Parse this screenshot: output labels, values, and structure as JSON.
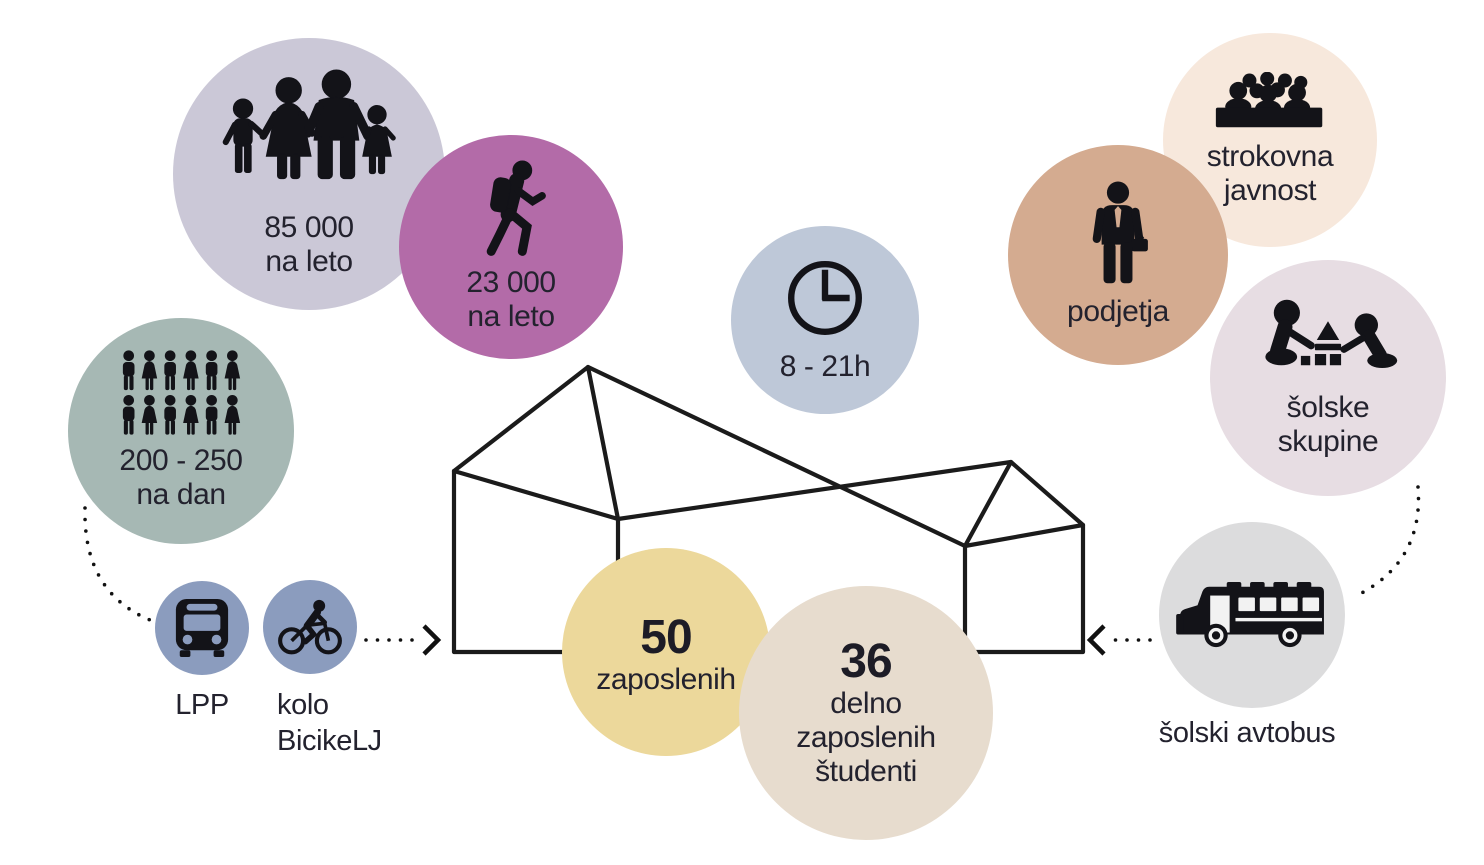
{
  "bubbles": {
    "annual_visitors": {
      "value": "85 000",
      "unit": "na leto"
    },
    "annual_hikers": {
      "value": "23 000",
      "unit": "na leto"
    },
    "daily_visitors": {
      "value": "200 - 250",
      "unit": "na dan"
    },
    "opening_hours": {
      "value": "8 - 21h"
    },
    "companies": {
      "label": "podjetja"
    },
    "professional_public": {
      "line1": "strokovna",
      "line2": "javnost"
    },
    "school_groups": {
      "line1": "šolske",
      "line2": "skupine"
    },
    "employees": {
      "value": "50",
      "label": "zaposlenih"
    },
    "student_workers": {
      "value": "36",
      "line1": "delno",
      "line2": "zaposlenih",
      "line3": "študenti"
    }
  },
  "labels": {
    "city_bus": "LPP",
    "bike_line1": "kolo",
    "bike_line2": "BicikeLJ",
    "school_bus": "šolski avtobus"
  },
  "icons": [
    "family-icon",
    "hiker-icon",
    "people-grid-icon",
    "city-bus-icon",
    "bicycle-icon",
    "clock-icon",
    "businessman-icon",
    "audience-icon",
    "children-blocks-icon",
    "school-bus-icon"
  ],
  "palette": {
    "annual_visitors_circle": "#cbc8d7",
    "annual_hikers_circle": "#b36ba8",
    "daily_visitors_circle": "#a6b8b4",
    "transport_circle": "#8b9cbe",
    "opening_hours_circle": "#bec8d8",
    "companies_circle": "#d4ab90",
    "professional_public_circle": "#f7e8dc",
    "school_groups_circle": "#e7dde3",
    "school_bus_circle": "#dcdcdd",
    "employees_circle": "#ecd89b",
    "student_workers_circle": "#e7dcce",
    "ink": "#1b1b1b"
  }
}
